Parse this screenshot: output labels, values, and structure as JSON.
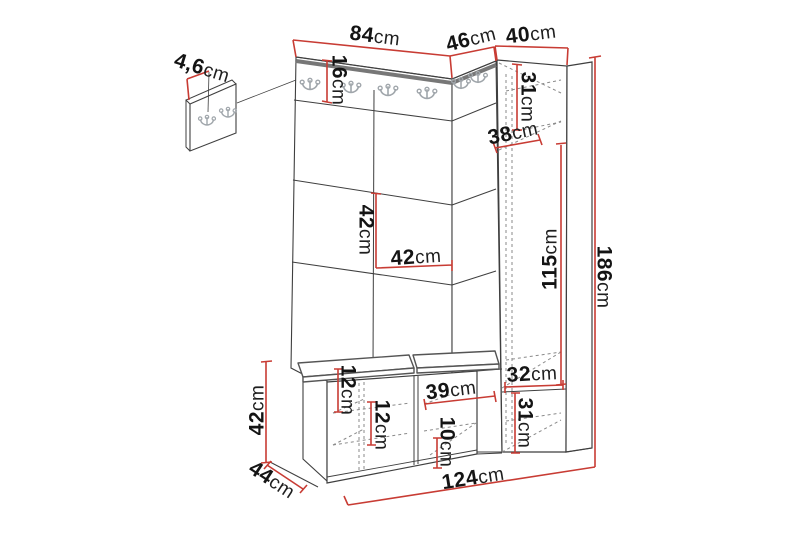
{
  "diagram": {
    "description": "Hallway furniture set (hall tree with hook panel, corner wardrobe and shoe bench) dimensional line drawing",
    "unit": "cm"
  },
  "colors": {
    "dimension_red": "#c83c34",
    "outline_gray": "#3f3f3f",
    "molding_gray": "#777777",
    "hook_gray": "#a0a6ab"
  },
  "dims": {
    "top_main_width": {
      "v": "84",
      "u": "cm"
    },
    "top_corner_width": {
      "v": "46",
      "u": "cm"
    },
    "top_cabinet_width": {
      "v": "40",
      "u": "cm"
    },
    "hook_panel_depth": {
      "v": "4,6",
      "u": "cm"
    },
    "hook_rail_height": {
      "v": "16",
      "u": "cm"
    },
    "cabinet_top_section_height": {
      "v": "31",
      "u": "cm"
    },
    "cabinet_depth": {
      "v": "38",
      "u": "cm"
    },
    "panel_tile_height": {
      "v": "42",
      "u": "cm"
    },
    "panel_tile_width": {
      "v": "42",
      "u": "cm"
    },
    "cabinet_interior_height": {
      "v": "115",
      "u": "cm"
    },
    "total_height": {
      "v": "186",
      "u": "cm"
    },
    "bench_height": {
      "v": "42",
      "u": "cm"
    },
    "bench_depth": {
      "v": "44",
      "u": "cm"
    },
    "bench_upper_compartment_height": {
      "v": "12",
      "u": "cm"
    },
    "bench_lower_compartment_height": {
      "v": "12",
      "u": "cm"
    },
    "bench_compartment_width": {
      "v": "39",
      "u": "cm"
    },
    "bench_shelf_height": {
      "v": "10",
      "u": "cm"
    },
    "cabinet_bottom_width": {
      "v": "32",
      "u": "cm"
    },
    "cabinet_bottom_section_height": {
      "v": "31",
      "u": "cm"
    },
    "total_width": {
      "v": "124",
      "u": "cm"
    }
  }
}
